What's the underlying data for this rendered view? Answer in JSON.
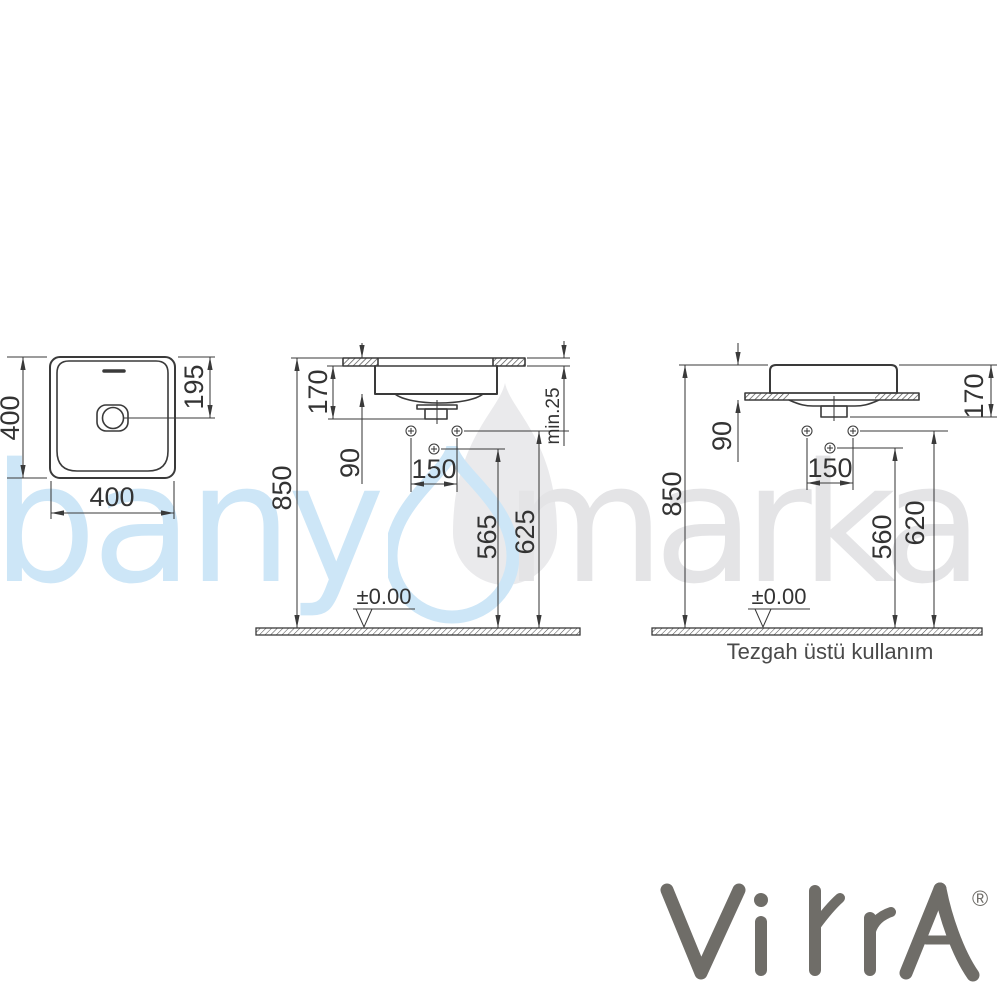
{
  "drawing": {
    "top_view": {
      "depth_label": "400",
      "width_label": "400",
      "drain_offset_label": "195"
    },
    "semi_recessed_view": {
      "basin_height_label": "170",
      "tap_offset_label": "90",
      "rim_height_label": "850",
      "hole_spacing_label": "150",
      "lower_connection_label": "565",
      "upper_connection_label": "625",
      "counter_thickness_label": "min.25",
      "floor_datum_label": "±0.00"
    },
    "countertop_view": {
      "basin_height_label": "170",
      "tap_offset_label": "90",
      "rim_height_label": "850",
      "hole_spacing_label": "150",
      "lower_connection_label": "560",
      "upper_connection_label": "620",
      "floor_datum_label": "±0.00",
      "caption": "Tezgah üstü kullanım"
    }
  },
  "watermark": {
    "text_left": "bany",
    "text_right": "marka",
    "droplet_icon": "droplet-icon",
    "blue": "#cde6f7",
    "gray": "#e4e4e6",
    "droplet_gray_fill": "#eaeaec"
  },
  "brand": {
    "name": "VitrA",
    "registered_mark": "®",
    "color": "#6f6d68"
  },
  "style": {
    "line_color": "#3a3a3a",
    "text_color": "#333333",
    "background": "#ffffff"
  }
}
